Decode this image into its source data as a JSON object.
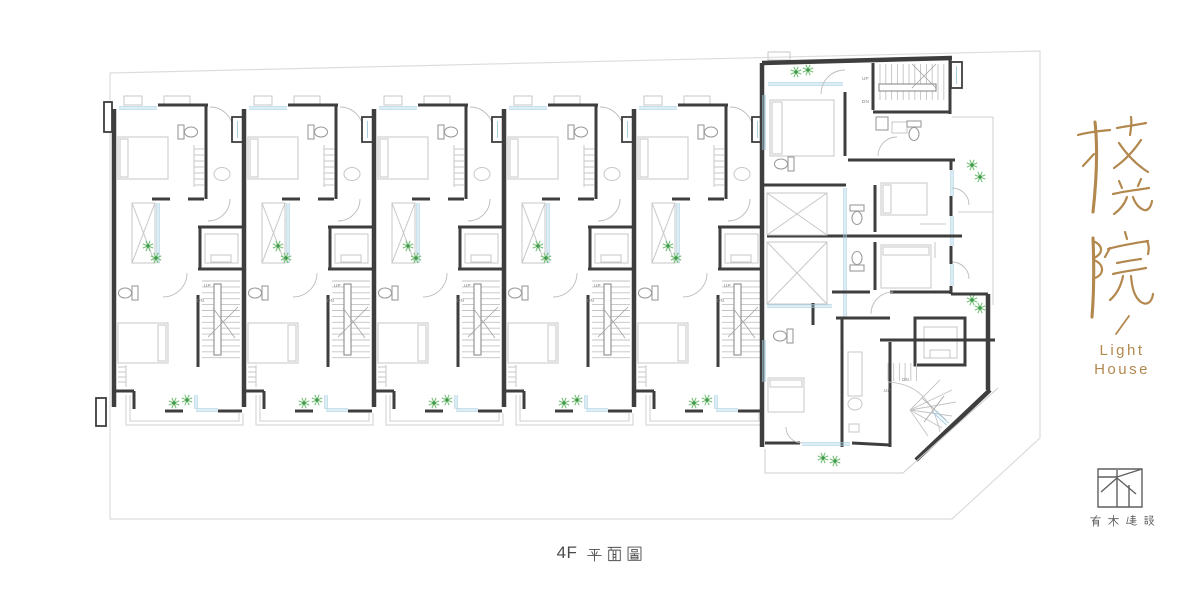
{
  "plan": {
    "sheet_label": {
      "prefix": "4F",
      "cjk": "平面圖"
    },
    "labels": {
      "up": "UP",
      "dn": "DN"
    },
    "unit_count": 5,
    "colors": {
      "wall": "#3e3e3e",
      "furniture": "#c7c7c7",
      "fixture": "#9c9c9c",
      "glass": "#a6cfe3",
      "plant": "#3f9b4a",
      "plant_rays": "#7fc27f",
      "boundary": "#dcdcdc",
      "label": "#7d7d7d"
    }
  },
  "brand": {
    "name": "枝光院",
    "english_line1": "Light",
    "english_line2": "House",
    "divider": "/",
    "color": "#b2884e"
  },
  "company": {
    "name": "有木建設",
    "color": "#565656"
  }
}
